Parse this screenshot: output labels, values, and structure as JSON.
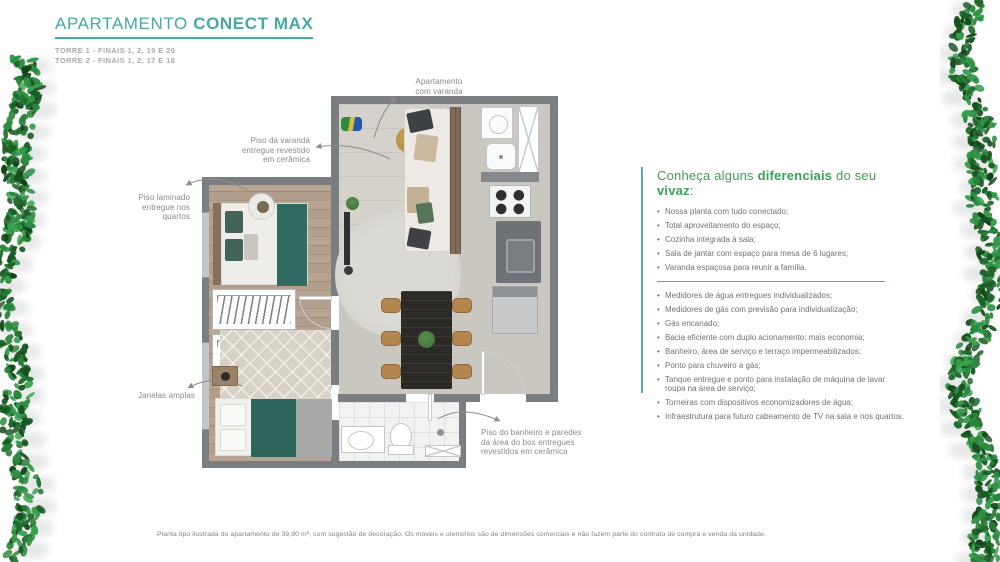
{
  "header": {
    "title_regular": "APARTAMENTO ",
    "title_bold": "CONECT MAX",
    "subtitle_line1": "TORRE 1 - FINAIS 1, 2, 19 E 20",
    "subtitle_line2": "TORRE 2 - FINAIS 1, 2, 17 E 18"
  },
  "floorplan": {
    "annotations": {
      "varanda": [
        "Apartamento",
        "com varanda"
      ],
      "piso_varanda": [
        "Piso da varanda",
        "entregue revestido",
        "em cerâmica"
      ],
      "piso_laminado": [
        "Piso laminado",
        "entregue nos",
        "quartos"
      ],
      "janelas": [
        "Janelas amplas"
      ],
      "piso_banheiro": [
        "Piso do banheiro e paredes",
        "da área do box entregues",
        "revestidos em cerâmica"
      ]
    }
  },
  "features": {
    "heading": {
      "part1": "Conheça alguns ",
      "part2_bold": "diferenciais",
      "part3": " do seu ",
      "part4_bold": "vivaz",
      "part5": ":"
    },
    "group1": [
      "Nossa planta com tudo conectado;",
      "Total aproveitamento do espaço;",
      "Cozinha integrada à sala;",
      "Sala de jantar com espaço para mesa de 6 lugares;",
      "Varanda espaçosa para reunir a família."
    ],
    "group2": [
      "Medidores de água entregues individualizados;",
      "Medidores de gás com previsão para individualização;",
      "Gás encanado;",
      "Bacia eficiente com duplo acionamento: mais economia;",
      "Banheiro, área de serviço e terraço impermeabilizados;",
      "Ponto para chuveiro a gás;",
      "Tanque entregue e ponto para instalação de máquina de lavar roupa na área de serviço;",
      "Torneiras com dispositivos economizadores de água;",
      "Infraestrutura para futuro cabeamento de TV na sala e nos quartos."
    ]
  },
  "disclaimer": "Planta tipo ilustrada do apartamento de 39,90 m², com sugestão de decoração. Os móveis e utensílios são de dimensões comerciais e não fazem parte do contrato de compra e venda da unidade.",
  "colors": {
    "brand_teal": "#45a9a5",
    "brand_green": "#3ba156",
    "panel_line_teal": "#4db3a6",
    "text_gray": "#707275",
    "annotation_gray": "#87898c",
    "wall_gray": "#7b7e80"
  }
}
